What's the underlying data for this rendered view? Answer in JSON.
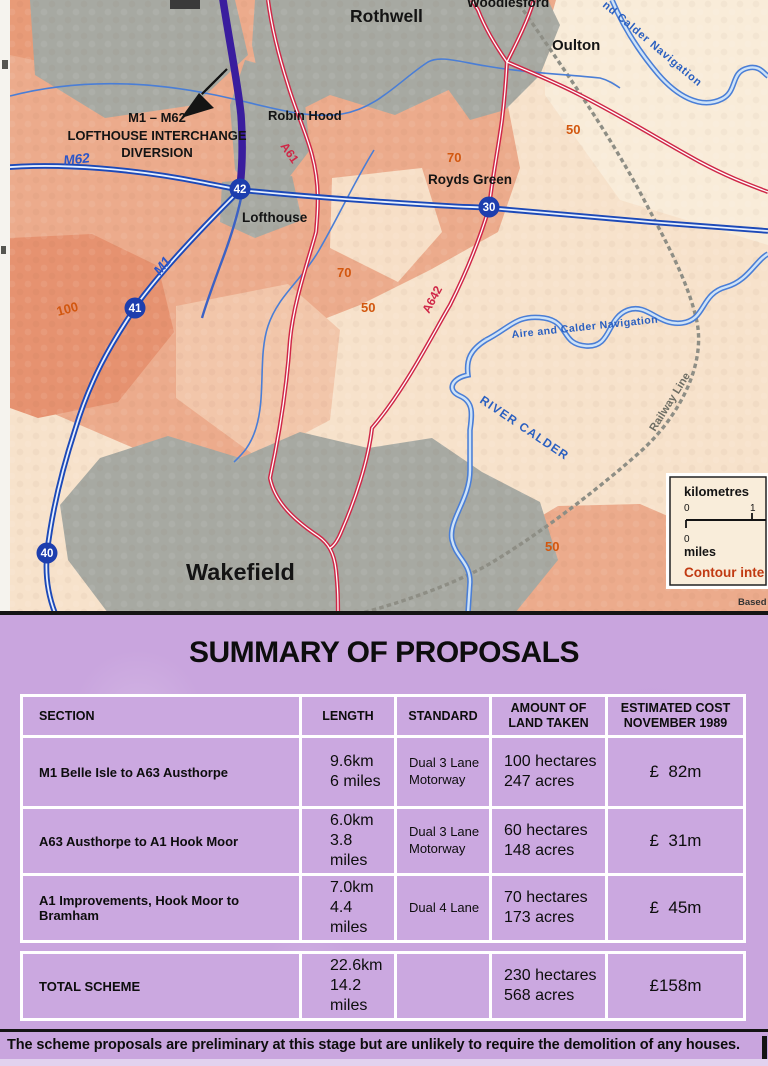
{
  "map": {
    "annotation": {
      "line1": "M1 – M62",
      "line2": "LOFTHOUSE INTERCHANGE",
      "line3": "DIVERSION"
    },
    "places": {
      "rothwell": "Rothwell",
      "woodlesford": "Woodlesford",
      "oulton": "Oulton",
      "robin_hood": "Robin Hood",
      "royds_green": "Royds Green",
      "lofthouse": "Lofthouse",
      "wakefield": "Wakefield"
    },
    "roads": {
      "m62": "M62",
      "m1": "M1",
      "a61": "A61",
      "a642": "A642"
    },
    "junctions": {
      "j42": "42",
      "j30": "30",
      "j41": "41",
      "j40": "40"
    },
    "contours": {
      "c100": "100",
      "c70_upper": "70",
      "c50_upper": "50",
      "c70_mid": "70",
      "c50_mid": "50",
      "c50_lower": "50"
    },
    "waterways": {
      "calder_navigation_upper": "nd Calder Navigation",
      "aire_and_calder": "Aire and Calder  Navigation",
      "river_calder": "RIVER CALDER"
    },
    "railway_label": "Railway Line",
    "scale_box": {
      "kilometres_label": "kilometres",
      "km_start": "0",
      "km_end": "1",
      "miles_start": "0",
      "miles_label": "miles",
      "contour_note": "Contour inte"
    },
    "credit": "Based",
    "colors": {
      "motorway_blue": "#1c49b8",
      "diversion_purple": "#3a1d9e",
      "a_road_red": "#cf2747",
      "contour_orange": "#d2570f",
      "urban_grey": "#a7a9a2",
      "land_salmon": "#ecab8c",
      "panel_purple": "#c9a5de"
    }
  },
  "summary": {
    "title": "SUMMARY OF PROPOSALS",
    "table": {
      "headers": {
        "section": "SECTION",
        "length": "LENGTH",
        "standard": "STANDARD",
        "land": "AMOUNT OF\nLAND TAKEN",
        "cost": "ESTIMATED COST\nNOVEMBER 1989"
      },
      "rows": [
        {
          "section": "M1 Belle Isle to A63 Austhorpe",
          "length": "9.6km\n6 miles",
          "standard": "Dual 3 Lane\nMotorway",
          "land": "100 hectares\n247 acres",
          "cost": "£  82m"
        },
        {
          "section": "A63 Austhorpe to A1 Hook Moor",
          "length": "6.0km\n3.8 miles",
          "standard": "Dual 3 Lane\nMotorway",
          "land": "60 hectares\n148 acres",
          "cost": "£  31m"
        },
        {
          "section": "A1 Improvements, Hook Moor to Bramham",
          "length": "7.0km\n4.4 miles",
          "standard": "Dual 4 Lane",
          "land": "70 hectares\n173 acres",
          "cost": "£  45m"
        }
      ],
      "total": {
        "section": "TOTAL SCHEME",
        "length": "22.6km\n14.2 miles",
        "standard": "",
        "land": "230 hectares\n568 acres",
        "cost": "£158m"
      }
    },
    "footnote": "The scheme proposals are preliminary at this stage but are unlikely to require the demolition of any houses."
  }
}
